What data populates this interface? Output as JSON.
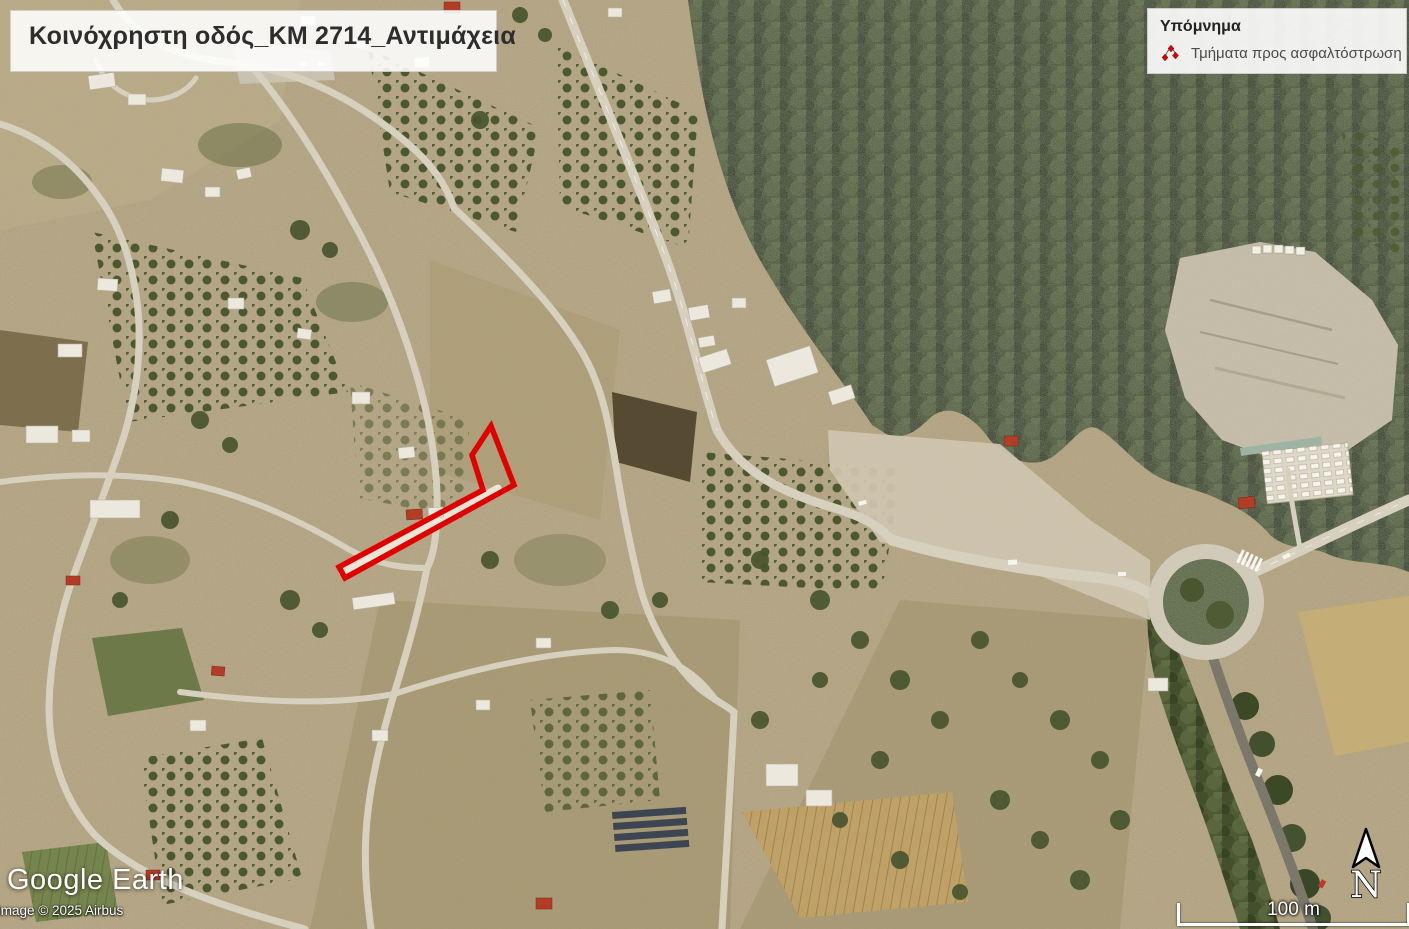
{
  "title": "Κοινόχρηστη οδός_ΚΜ 2714_Αντιμάχεια",
  "legend": {
    "title": "Υπόμνημα",
    "items": [
      {
        "label": "Τμήματα προς ασφαλτόστρωση",
        "icon": "route-vertices-icon",
        "color": "#e00000"
      }
    ]
  },
  "attribution": {
    "logo": "Google Earth",
    "copyright": "Image © 2025 Airbus"
  },
  "scale_bar": {
    "label": "100 m"
  },
  "compass": {
    "label": "N"
  }
}
